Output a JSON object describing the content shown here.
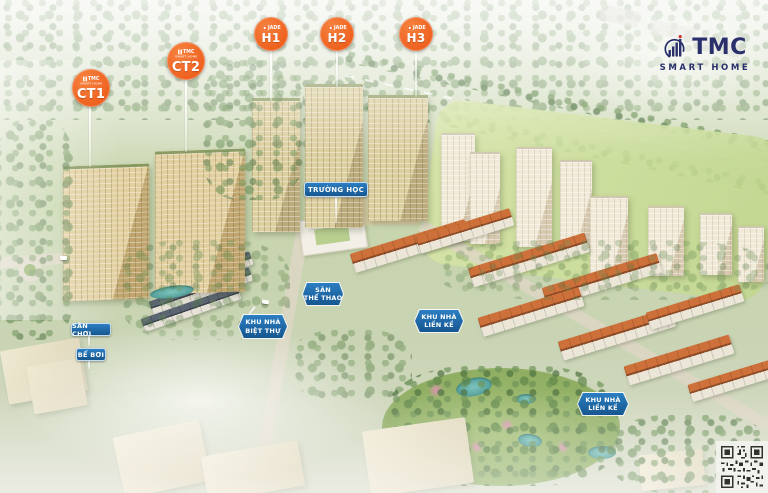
{
  "project_logo": {
    "title": "TMC",
    "subtitle": "SMART HOME"
  },
  "tower_badges": {
    "ct1": {
      "brand": "TMC",
      "brand_sub": "SMART HOME",
      "id": "CT1"
    },
    "ct2": {
      "brand": "TMC",
      "brand_sub": "SMART HOME",
      "id": "CT2"
    },
    "h1": {
      "brand": "JADE",
      "id": "H1"
    },
    "h2": {
      "brand": "JADE",
      "id": "H2"
    },
    "h3": {
      "brand": "JADE",
      "id": "H3"
    }
  },
  "area_labels": {
    "school": {
      "line1": "TRƯỜNG HỌC"
    },
    "sports_field": {
      "line1": "SÂN",
      "line2": "THỂ THAO"
    },
    "playground": {
      "line1": "SÂN CHƠI"
    },
    "swimming_pool": {
      "line1": "BỂ BƠI"
    },
    "villa_area": {
      "line1": "KHU NHÀ",
      "line2": "BIỆT THỰ"
    },
    "townhouse_area_1": {
      "line1": "KHU NHÀ",
      "line2": "LIỀN KỀ"
    },
    "townhouse_area_2": {
      "line1": "KHU NHÀ",
      "line2": "LIỀN KỀ"
    }
  },
  "colors": {
    "badge_orange": "#EE5F1D",
    "label_blue": "#1A68B0",
    "logo_navy": "#29306B",
    "logo_red": "#D0342C"
  }
}
